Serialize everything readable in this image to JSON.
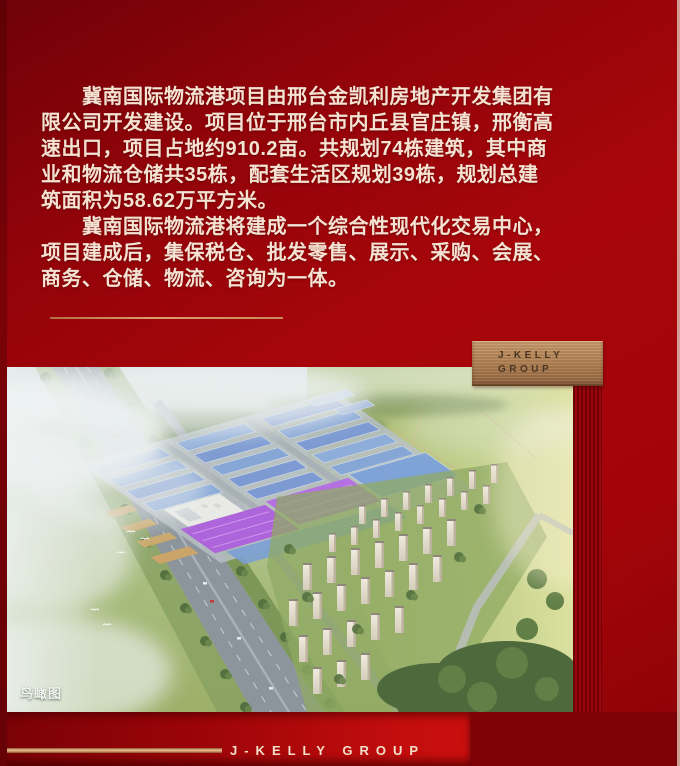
{
  "intro": {
    "p1_lines": [
      "　　冀南国际物流港项目由邢台金凯利房地产开发集团有",
      "限公司开发建设。项目位于邢台市内丘县官庄镇，邢衡高",
      "速出口，项目占地约910.2亩。共规划74栋建筑，其中商",
      "业和物流仓储共35栋，配套生活区规划39栋，规划总建",
      "筑面积为58.62万平方米。"
    ],
    "p2_lines": [
      "　　冀南国际物流港将建成一个综合性现代化交易中心，",
      "项目建成后，集保税仓、批发零售、展示、采购、会展、",
      "商务、仓储、物流、咨询为一体。"
    ]
  },
  "badge": {
    "line1": "J-KELLY",
    "line2": "GROUP"
  },
  "aerial": {
    "label": "鸟瞰图"
  },
  "footer": {
    "brand": "J-KELLY GROUP"
  },
  "colors": {
    "background_red": "#a30409",
    "dark_red": "#6e0207",
    "bright_red": "#c30d0d",
    "bronze": "#b68758",
    "gold_accent": "#dd9e66",
    "body_text": "#f4e3d2"
  }
}
